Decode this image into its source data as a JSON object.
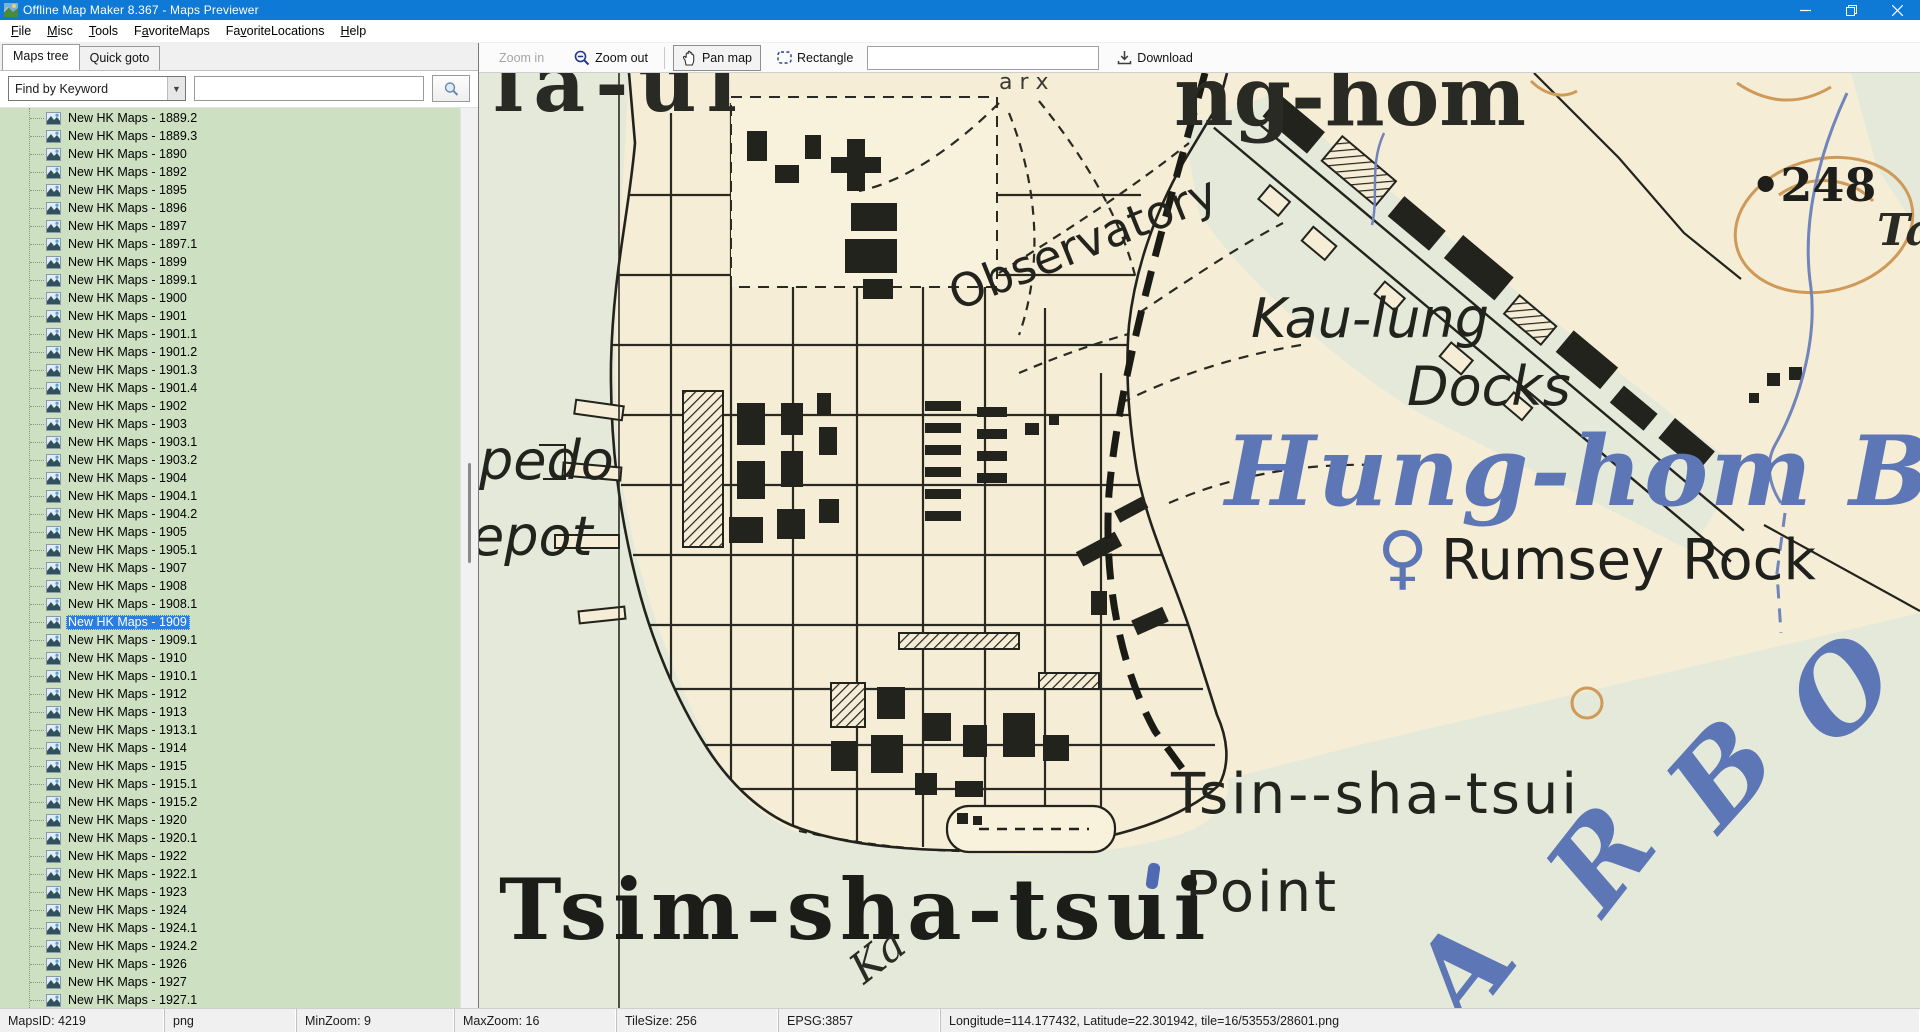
{
  "window": {
    "title": "Offline Map Maker 8.367 - Maps Previewer"
  },
  "menu": {
    "items": [
      {
        "pre": "",
        "key": "F",
        "post": "ile"
      },
      {
        "pre": "",
        "key": "M",
        "post": "isc"
      },
      {
        "pre": "",
        "key": "T",
        "post": "ools"
      },
      {
        "pre": "F",
        "key": "a",
        "post": "voriteMaps"
      },
      {
        "pre": "Fa",
        "key": "v",
        "post": "oriteLocations"
      },
      {
        "pre": "",
        "key": "H",
        "post": "elp"
      }
    ]
  },
  "sidebar": {
    "tabs": [
      {
        "label": "Maps tree",
        "active": true
      },
      {
        "label": "Quick goto",
        "active": false
      }
    ],
    "search": {
      "dropdown_value": "Find by Keyword",
      "input_value": "",
      "input_placeholder": ""
    },
    "tree": {
      "item_prefix": "New HK Maps - ",
      "years": [
        "1889.2",
        "1889.3",
        "1890",
        "1892",
        "1895",
        "1896",
        "1897",
        "1897.1",
        "1899",
        "1899.1",
        "1900",
        "1901",
        "1901.1",
        "1901.2",
        "1901.3",
        "1901.4",
        "1902",
        "1903",
        "1903.1",
        "1903.2",
        "1904",
        "1904.1",
        "1904.2",
        "1905",
        "1905.1",
        "1907",
        "1908",
        "1908.1",
        "1909",
        "1909.1",
        "1910",
        "1910.1",
        "1912",
        "1913",
        "1913.1",
        "1914",
        "1915",
        "1915.1",
        "1915.2",
        "1920",
        "1920.1",
        "1922",
        "1922.1",
        "1923",
        "1924",
        "1924.1",
        "1924.2",
        "1926",
        "1927",
        "1927.1"
      ],
      "selected_year": "1909"
    }
  },
  "toolbar": {
    "zoom_in": "Zoom in",
    "zoom_out": "Zoom out",
    "pan_map": "Pan map",
    "rectangle": "Rectangle",
    "coords_value": "",
    "download": "Download"
  },
  "statusbar": {
    "segments": [
      "MapsID: 4219",
      "png",
      "MinZoom: 9",
      "MaxZoom: 16",
      "TileSize: 256",
      "EPSG:3857",
      "Longitude=114.177432, Latitude=22.301942, tile=16/53553/28601.png"
    ]
  },
  "map": {
    "colors": {
      "paper": "#f5edd5",
      "water": "#e5e9d9",
      "ink": "#26261f",
      "blue": "#5d76b6",
      "contour": "#cf9a58"
    },
    "labels": [
      {
        "id": "sheet-title-left",
        "text": "la-ul",
        "x": 14,
        "y": 38,
        "size": 80,
        "font": "serif",
        "weight": "bold",
        "spacing": 10,
        "color": "#2a2a24"
      },
      {
        "id": "small-top-text",
        "text": "a r x",
        "x": 520,
        "y": 16,
        "size": 22,
        "font": "sans",
        "color": "#3a3a34"
      },
      {
        "id": "sheet-title-right",
        "text": "ng-hom",
        "x": 695,
        "y": 52,
        "size": 82,
        "font": "serif",
        "weight": "bold",
        "color": "#2a2a24"
      },
      {
        "id": "height-248",
        "text": "•248",
        "x": 1272,
        "y": 128,
        "size": 46,
        "font": "serif",
        "weight": "bold",
        "color": "#1e1e1a"
      },
      {
        "id": "ta-label",
        "text": "Ta",
        "x": 1398,
        "y": 172,
        "size": 44,
        "font": "serif",
        "weight": "bold",
        "style": "italic",
        "color": "#2a2a24"
      },
      {
        "id": "observatory",
        "text": "Observatory",
        "x": 478,
        "y": 238,
        "size": 46,
        "font": "sans",
        "rotate": -22,
        "color": "#23231e"
      },
      {
        "id": "kau-lung",
        "text": "Kau-lung",
        "x": 772,
        "y": 264,
        "size": 54,
        "font": "sans",
        "style": "italic",
        "color": "#23231e"
      },
      {
        "id": "docks",
        "text": "Docks",
        "x": 928,
        "y": 332,
        "size": 54,
        "font": "sans",
        "style": "italic",
        "color": "#23231e"
      },
      {
        "id": "hung-hom-bay",
        "text": "Hung-hom Bay",
        "x": 746,
        "y": 432,
        "size": 96,
        "font": "serif",
        "weight": "bold",
        "style": "italic",
        "spacing": 2,
        "color": "#5d76b6"
      },
      {
        "id": "buoy-glyph",
        "text": "♀",
        "x": 898,
        "y": 508,
        "size": 70,
        "font": "sans",
        "weight": "bold",
        "color": "#5d76b6"
      },
      {
        "id": "rumsey-rock",
        "text": "Rumsey Rock",
        "x": 962,
        "y": 506,
        "size": 56,
        "font": "sans",
        "color": "#20201c"
      },
      {
        "id": "tsin-sha-tsui-point-line1",
        "text": "Tsin--sha-tsui",
        "x": 692,
        "y": 740,
        "size": 56,
        "font": "sans",
        "spacing": 3,
        "color": "#24241f"
      },
      {
        "id": "tsin-sha-tsui-point-line2",
        "text": "Point",
        "x": 706,
        "y": 838,
        "size": 56,
        "font": "sans",
        "spacing": 3,
        "color": "#24241f"
      },
      {
        "id": "tsim-sha-tsui",
        "text": "Tsim-sha-tsui",
        "x": 20,
        "y": 866,
        "size": 84,
        "font": "serif",
        "weight": "bold",
        "spacing": 6,
        "color": "#1c1c18"
      },
      {
        "id": "ka-label",
        "text": "Ka",
        "x": 385,
        "y": 912,
        "size": 42,
        "font": "serif",
        "style": "italic",
        "rotate": -38,
        "color": "#2a2a24"
      },
      {
        "id": "torpedo-depot-line1",
        "text": "pedo",
        "x": 0,
        "y": 406,
        "size": 54,
        "font": "sans",
        "style": "italic",
        "color": "#23231e"
      },
      {
        "id": "torpedo-depot-line2",
        "text": "epot",
        "x": -8,
        "y": 482,
        "size": 54,
        "font": "sans",
        "style": "italic",
        "color": "#23231e"
      }
    ],
    "harbour_letters": [
      {
        "ch": "A",
        "x": 988,
        "y": 956,
        "rot": -52
      },
      {
        "ch": "R",
        "x": 1124,
        "y": 846,
        "rot": -52
      },
      {
        "ch": "B",
        "x": 1240,
        "y": 762,
        "rot": -48
      },
      {
        "ch": "O",
        "x": 1354,
        "y": 678,
        "rot": -44
      }
    ]
  }
}
